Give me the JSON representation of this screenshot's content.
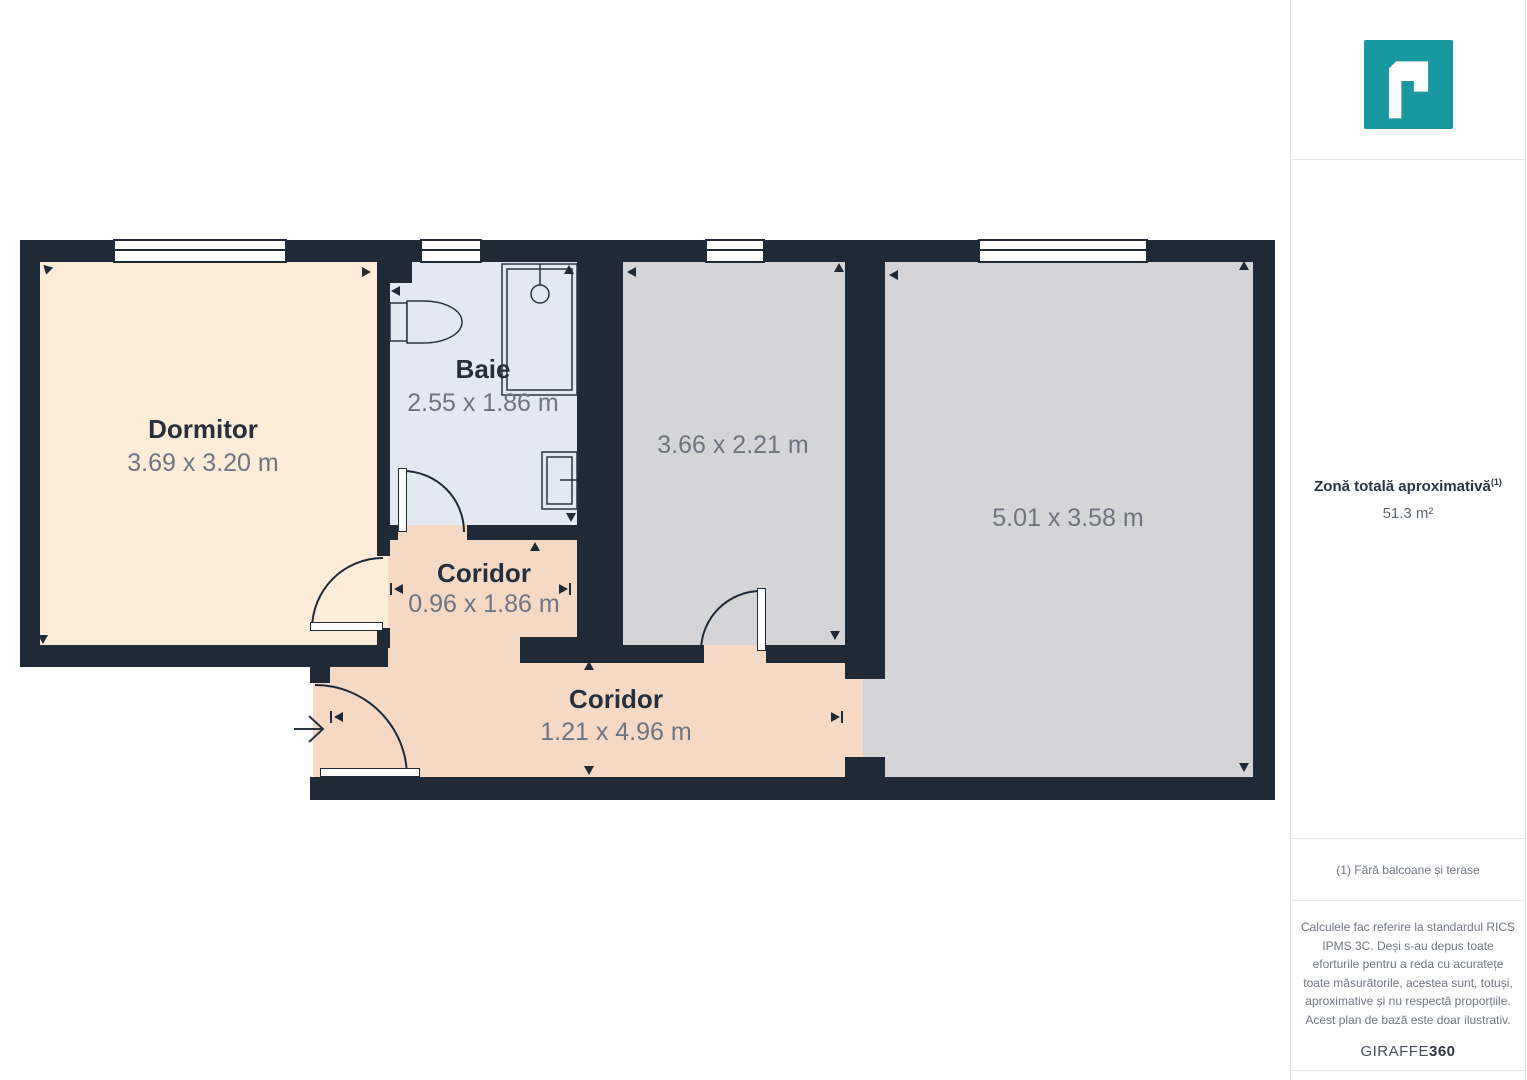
{
  "colors": {
    "wall": "#202a36",
    "cream": "#fdecd8",
    "blue": "#e3e9f2",
    "gray": "#d5d5d7",
    "peach": "#f6d9c4",
    "teal": "#18989f",
    "label": "#262f3c",
    "dim": "#6e7580"
  },
  "plan": {
    "rooms": [
      {
        "name": "Dormitor",
        "dimensions": "3.69 x 3.20 m"
      },
      {
        "name": "Baie",
        "dimensions": "2.55 x 1.86 m"
      },
      {
        "name": "",
        "dimensions": "3.66 x 2.21 m"
      },
      {
        "name": "",
        "dimensions": "5.01 x 3.58 m"
      },
      {
        "name": "Coridor",
        "dimensions": "0.96 x 1.86 m"
      },
      {
        "name": "Coridor",
        "dimensions": "1.21 x 4.96 m"
      }
    ]
  },
  "sidebar": {
    "total_area_label": "Zonă totală aproximativă",
    "total_area_superscript": "(1)",
    "total_area_value": "51.3 m²",
    "footnote": "(1) Fără balcoane și terase",
    "disclaimer": "Calculele fac referire la standardul RICS IPMS 3C. Deși s-au depus toate eforturile pentru a reda cu acuratețe toate măsurătorile, acestea sunt, totuși, aproximative și nu respectă proporțiile. Acest plan de bază este doar ilustrativ.",
    "brand_name": "GIRAFFE",
    "brand_suffix": "360"
  }
}
